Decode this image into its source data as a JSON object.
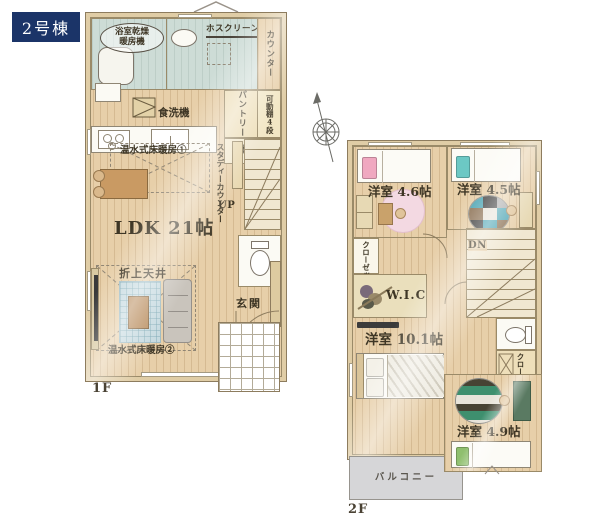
{
  "badge": {
    "text": "2号棟",
    "bg": "#1b3468"
  },
  "f1": {
    "floor": "1F",
    "bath_line1": "浴室乾燥",
    "bath_line2": "暖房機",
    "hos": "ホスクリーン",
    "counter": "カウンター",
    "pantry": "パントリー",
    "shelf": "可動棚4段",
    "dishwasher": "食洗機",
    "storage": "収納",
    "study": "スタディーカウンター",
    "heat1": "温水式床暖房①",
    "up": "UP",
    "ldk": "LDK 21帖",
    "coffer": "折上天井",
    "heat2": "温水式床暖房②",
    "genkan": "玄関"
  },
  "f2": {
    "floor": "2F",
    "r46": "洋室 4.6帖",
    "r45": "洋室 4.5帖",
    "closet1": "クローゼット",
    "dn": "DN",
    "wic": "W.I.C",
    "r101": "洋室 10.1帖",
    "closet2": "クローゼット",
    "r49": "洋室 4.9帖",
    "balcony": "バルコニー"
  },
  "colors": {
    "accent_navy": "#1b3468",
    "wood_floor": "#e7cfa9",
    "bath_teal": "#cddcd6",
    "balcony_gray": "#d6d6d8"
  }
}
